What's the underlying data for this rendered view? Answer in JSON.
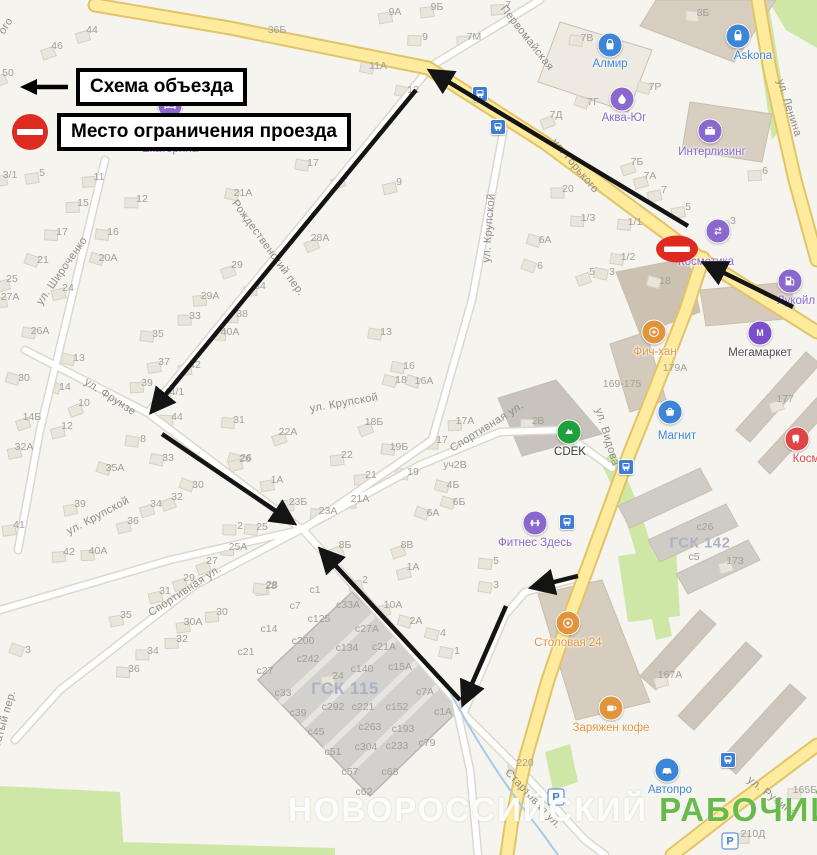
{
  "legend": {
    "items": [
      {
        "symbol": "detour-arrow",
        "label": "Схема объезда"
      },
      {
        "symbol": "no-entry",
        "label": "Место ограничения проезда"
      }
    ]
  },
  "watermark": {
    "part1": "НОВОРОССИЙСКИЙ",
    "part2": "РАБОЧИЙ",
    "color2": "#68ba4d"
  },
  "colors": {
    "background": "#f6f4ee",
    "road_main": "#ffeb9e",
    "road_main_casing": "#e2c468",
    "road_minor": "#ffffff",
    "road_minor_casing": "#dcd8cd",
    "green": "#cfe7a6",
    "water": "#a6cbe9",
    "building": "#e9e5db",
    "building_border": "#d6d1c6",
    "arrow": "#141414",
    "no_entry": "#dd2b20",
    "house_number_text": "#a3a09a",
    "street_text": "#8f8d88",
    "area_text": "#aab3c5"
  },
  "no_entry_sign": {
    "x": 677,
    "y": 249
  },
  "streets": [
    {
      "text": "Первомайская",
      "x": 527,
      "y": 38,
      "rot": 52
    },
    {
      "text": "ул. Горького",
      "x": 575,
      "y": 166,
      "rot": 50
    },
    {
      "text": "ул. Ленина",
      "x": 789,
      "y": 108,
      "rot": 72
    },
    {
      "text": "ул. Видова",
      "x": 607,
      "y": 437,
      "rot": 73
    },
    {
      "text": "ул. Крупской",
      "x": 489,
      "y": 228,
      "rot": -86
    },
    {
      "text": "ул. Крупской",
      "x": 344,
      "y": 403,
      "rot": -10
    },
    {
      "text": "ул. Крупской",
      "x": 98,
      "y": 516,
      "rot": -28
    },
    {
      "text": "ул. Фрунзе",
      "x": 110,
      "y": 397,
      "rot": 33
    },
    {
      "text": "ул. Широченко",
      "x": 62,
      "y": 271,
      "rot": -55
    },
    {
      "text": "Рождественский пер.",
      "x": 268,
      "y": 248,
      "rot": 54
    },
    {
      "text": "Спортивная ул.",
      "x": 487,
      "y": 427,
      "rot": -32
    },
    {
      "text": "Спортивная ул.",
      "x": 185,
      "y": 591,
      "rot": -33
    },
    {
      "text": "Стартовая ул.",
      "x": 533,
      "y": 799,
      "rot": 47
    },
    {
      "text": "ул. Рубина",
      "x": 772,
      "y": 797,
      "rot": 38
    },
    {
      "text": "ого",
      "x": 6,
      "y": 26,
      "rot": -58
    },
    {
      "text": "Горбатый пер.",
      "x": 2,
      "y": 728,
      "rot": -74
    }
  ],
  "area_labels": [
    {
      "text": "ГСК 115",
      "x": 345,
      "y": 689,
      "size": 17
    },
    {
      "text": "ГСК 142",
      "x": 700,
      "y": 543,
      "size": 15
    }
  ],
  "pois": [
    {
      "name": "Екатерина",
      "type": "bed",
      "color": "#8a68ce",
      "icon": [
        170,
        106
      ],
      "label": [
        170,
        143
      ]
    },
    {
      "name": "Алмир",
      "type": "bag",
      "color": "#3d85d6",
      "icon": [
        610,
        45
      ],
      "label": [
        610,
        58
      ]
    },
    {
      "name": "Askona",
      "type": "bag",
      "color": "#3d85d6",
      "icon": [
        738,
        36
      ],
      "label": [
        753,
        50
      ]
    },
    {
      "name": "Аква-Юг",
      "type": "drop",
      "color": "#8a68ce",
      "icon": [
        622,
        99
      ],
      "label": [
        624,
        112
      ]
    },
    {
      "name": "Интерлизинг",
      "type": "case",
      "color": "#8a68ce",
      "icon": [
        710,
        131
      ],
      "label": [
        712,
        146
      ]
    },
    {
      "name": "Косметика",
      "type": "swap",
      "color": "#8a68ce",
      "icon": [
        718,
        231
      ],
      "label": [
        706,
        256
      ]
    },
    {
      "name": "Лукойл",
      "type": "fuel",
      "color": "#8a68ce",
      "icon": [
        790,
        281
      ],
      "label": [
        796,
        295
      ]
    },
    {
      "name": "Мегамаркет",
      "type": "m",
      "color": "#7b4fc9",
      "icon": [
        760,
        333
      ],
      "label": [
        760,
        347
      ],
      "label_color": "#4e4a56"
    },
    {
      "name": "Фич-хан",
      "type": "food",
      "color": "#e2943c",
      "icon": [
        654,
        332
      ],
      "label": [
        655,
        346
      ]
    },
    {
      "name": "CDEK",
      "type": "cdek",
      "color": "#1ea03c",
      "icon": [
        569,
        432
      ],
      "label": [
        570,
        446
      ],
      "label_color": "#3c3c3c"
    },
    {
      "name": "Магнит",
      "type": "cart",
      "color": "#3d85d6",
      "icon": [
        670,
        412
      ],
      "label": [
        677,
        430
      ]
    },
    {
      "name": "Фитнес Здесь",
      "type": "dumbbell",
      "color": "#8a68ce",
      "icon": [
        535,
        523
      ],
      "label": [
        535,
        537
      ]
    },
    {
      "name": "Столовая 24",
      "type": "food",
      "color": "#e2943c",
      "icon": [
        568,
        623
      ],
      "label": [
        568,
        637
      ]
    },
    {
      "name": "Заряжен кофе",
      "type": "coffee",
      "color": "#e2943c",
      "icon": [
        611,
        708
      ],
      "label": [
        611,
        722
      ]
    },
    {
      "name": "Автопро",
      "type": "car",
      "color": "#3d85d6",
      "icon": [
        667,
        770
      ],
      "label": [
        670,
        784
      ]
    },
    {
      "name": "Косм",
      "type": "tooth",
      "color": "#e04545",
      "icon": [
        797,
        439
      ],
      "label": [
        806,
        453
      ],
      "label_color": "#e04545"
    }
  ],
  "transport": {
    "bus_stops": [
      [
        480,
        94
      ],
      [
        498,
        127
      ],
      [
        567,
        522
      ],
      [
        626,
        467
      ],
      [
        728,
        760
      ]
    ],
    "parking": [
      [
        556,
        797
      ],
      [
        730,
        841
      ]
    ],
    "parking_glyph": "P"
  },
  "house_numbers": [
    [
      "50",
      8,
      73
    ],
    [
      "46",
      57,
      46
    ],
    [
      "44",
      92,
      30
    ],
    [
      "36Б",
      277,
      30
    ],
    [
      "9А",
      395,
      12
    ],
    [
      "9Б",
      437,
      7
    ],
    [
      "7",
      508,
      5
    ],
    [
      "7М",
      474,
      37
    ],
    [
      "9",
      425,
      37
    ],
    [
      "8Б",
      703,
      13
    ],
    [
      "7В",
      587,
      38
    ],
    [
      "11А",
      378,
      66
    ],
    [
      "12",
      413,
      90
    ],
    [
      "7Р",
      655,
      87
    ],
    [
      "7Г",
      593,
      102
    ],
    [
      "7Д",
      556,
      115
    ],
    [
      "7Б",
      637,
      162
    ],
    [
      "7А",
      650,
      176
    ],
    [
      "7",
      664,
      190
    ],
    [
      "5",
      688,
      207
    ],
    [
      "3",
      733,
      221
    ],
    [
      "6",
      765,
      171
    ],
    [
      "20",
      568,
      189
    ],
    [
      "1/3",
      588,
      218
    ],
    [
      "1/1",
      635,
      222
    ],
    [
      "1/2",
      628,
      257
    ],
    [
      "3",
      612,
      272
    ],
    [
      "18",
      665,
      281
    ],
    [
      "6А",
      545,
      240
    ],
    [
      "6",
      540,
      266
    ],
    [
      "5",
      592,
      272
    ],
    [
      "7",
      347,
      176
    ],
    [
      "9",
      399,
      182
    ],
    [
      "3/1",
      10,
      175
    ],
    [
      "5",
      42,
      173
    ],
    [
      "11",
      99,
      177
    ],
    [
      "15",
      83,
      203
    ],
    [
      "12",
      142,
      199
    ],
    [
      "17",
      62,
      232
    ],
    [
      "16",
      113,
      232
    ],
    [
      "17",
      313,
      163
    ],
    [
      "21А",
      243,
      193
    ],
    [
      "20А",
      108,
      258
    ],
    [
      "21",
      43,
      260
    ],
    [
      "28А",
      320,
      238
    ],
    [
      "29",
      237,
      265
    ],
    [
      "25",
      12,
      279
    ],
    [
      "24",
      68,
      288
    ],
    [
      "27А",
      10,
      297
    ],
    [
      "34",
      260,
      286
    ],
    [
      "29А",
      210,
      296
    ],
    [
      "33",
      195,
      316
    ],
    [
      "38",
      242,
      314
    ],
    [
      "40А",
      230,
      332
    ],
    [
      "35",
      158,
      334
    ],
    [
      "26А",
      40,
      331
    ],
    [
      "13",
      79,
      358
    ],
    [
      "30",
      24,
      378
    ],
    [
      "14",
      65,
      387
    ],
    [
      "10",
      84,
      403
    ],
    [
      "14Б",
      32,
      417
    ],
    [
      "12",
      67,
      426
    ],
    [
      "32А",
      24,
      447
    ],
    [
      "37",
      164,
      362
    ],
    [
      "42",
      195,
      365
    ],
    [
      "39",
      147,
      383
    ],
    [
      "44/1",
      174,
      392
    ],
    [
      "44",
      177,
      417
    ],
    [
      "31",
      239,
      420
    ],
    [
      "8",
      143,
      439
    ],
    [
      "33",
      168,
      458
    ],
    [
      "26",
      246,
      458
    ],
    [
      "35А",
      115,
      468
    ],
    [
      "30",
      198,
      485
    ],
    [
      "32",
      177,
      497
    ],
    [
      "34",
      156,
      504
    ],
    [
      "36",
      133,
      521
    ],
    [
      "39",
      80,
      504
    ],
    [
      "41",
      19,
      525
    ],
    [
      "42",
      69,
      552
    ],
    [
      "40А",
      98,
      551
    ],
    [
      "2",
      240,
      526
    ],
    [
      "25А",
      238,
      547
    ],
    [
      "25",
      262,
      527
    ],
    [
      "13",
      386,
      332
    ],
    [
      "16",
      409,
      366
    ],
    [
      "18",
      401,
      380
    ],
    [
      "16А",
      424,
      381
    ],
    [
      "18Б",
      374,
      422
    ],
    [
      "22А",
      288,
      432
    ],
    [
      "уч2В",
      455,
      465
    ],
    [
      "26",
      245,
      459
    ],
    [
      "1А",
      277,
      480
    ],
    [
      "22",
      347,
      455
    ],
    [
      "21",
      371,
      475
    ],
    [
      "21А",
      360,
      499
    ],
    [
      "23Б",
      298,
      502
    ],
    [
      "23А",
      328,
      511
    ],
    [
      "19Б",
      399,
      447
    ],
    [
      "19",
      413,
      472
    ],
    [
      "4Б",
      453,
      485
    ],
    [
      "6Б",
      459,
      502
    ],
    [
      "6А",
      433,
      513
    ],
    [
      "8Б",
      345,
      545
    ],
    [
      "8В",
      407,
      545
    ],
    [
      "1А",
      413,
      567
    ],
    [
      "2",
      365,
      580
    ],
    [
      "10А",
      393,
      605
    ],
    [
      "28",
      272,
      585
    ],
    [
      "17А",
      465,
      421
    ],
    [
      "17",
      442,
      440
    ],
    [
      "2В",
      538,
      421
    ],
    [
      "5",
      496,
      561
    ],
    [
      "3",
      496,
      585
    ],
    [
      "1",
      457,
      651
    ],
    [
      "4",
      443,
      633
    ],
    [
      "2А",
      416,
      621
    ],
    [
      "3",
      28,
      650
    ],
    [
      "27",
      212,
      561
    ],
    [
      "29",
      189,
      578
    ],
    [
      "31",
      165,
      591
    ],
    [
      "35",
      126,
      615
    ],
    [
      "30А",
      193,
      622
    ],
    [
      "30",
      222,
      612
    ],
    [
      "32",
      182,
      639
    ],
    [
      "34",
      153,
      651
    ],
    [
      "36",
      134,
      669
    ],
    [
      "28",
      271,
      586
    ],
    [
      "с1",
      315,
      590
    ],
    [
      "с7",
      295,
      606
    ],
    [
      "с33А",
      348,
      605
    ],
    [
      "с125",
      319,
      619
    ],
    [
      "с14",
      269,
      629
    ],
    [
      "с200",
      303,
      641
    ],
    [
      "с21",
      246,
      652
    ],
    [
      "с242",
      308,
      659
    ],
    [
      "с27",
      265,
      671
    ],
    [
      "24",
      338,
      676
    ],
    [
      "с33",
      283,
      693
    ],
    [
      "с39",
      298,
      713
    ],
    [
      "с292",
      333,
      707
    ],
    [
      "с221",
      363,
      707
    ],
    [
      "с152",
      397,
      707
    ],
    [
      "с45",
      316,
      732
    ],
    [
      "с263",
      370,
      727
    ],
    [
      "с193",
      403,
      729
    ],
    [
      "с51",
      333,
      752
    ],
    [
      "с304",
      366,
      747
    ],
    [
      "с233",
      397,
      746
    ],
    [
      "с79",
      427,
      743
    ],
    [
      "с57",
      350,
      772
    ],
    [
      "с68",
      390,
      772
    ],
    [
      "с62",
      364,
      792
    ],
    [
      "с1А",
      443,
      712
    ],
    [
      "с7А",
      425,
      692
    ],
    [
      "с15А",
      400,
      667
    ],
    [
      "с140",
      362,
      669
    ],
    [
      "с134",
      347,
      648
    ],
    [
      "с21А",
      384,
      647
    ],
    [
      "с27А",
      367,
      629
    ],
    [
      "169-175",
      622,
      384
    ],
    [
      "179А",
      675,
      368
    ],
    [
      "177",
      785,
      399
    ],
    [
      "167А",
      670,
      675
    ],
    [
      "173",
      735,
      561
    ],
    [
      "с26",
      705,
      527
    ],
    [
      "с5",
      694,
      557
    ],
    [
      "220",
      525,
      763
    ],
    [
      "210Д",
      753,
      834
    ],
    [
      "165Б",
      805,
      790
    ]
  ]
}
